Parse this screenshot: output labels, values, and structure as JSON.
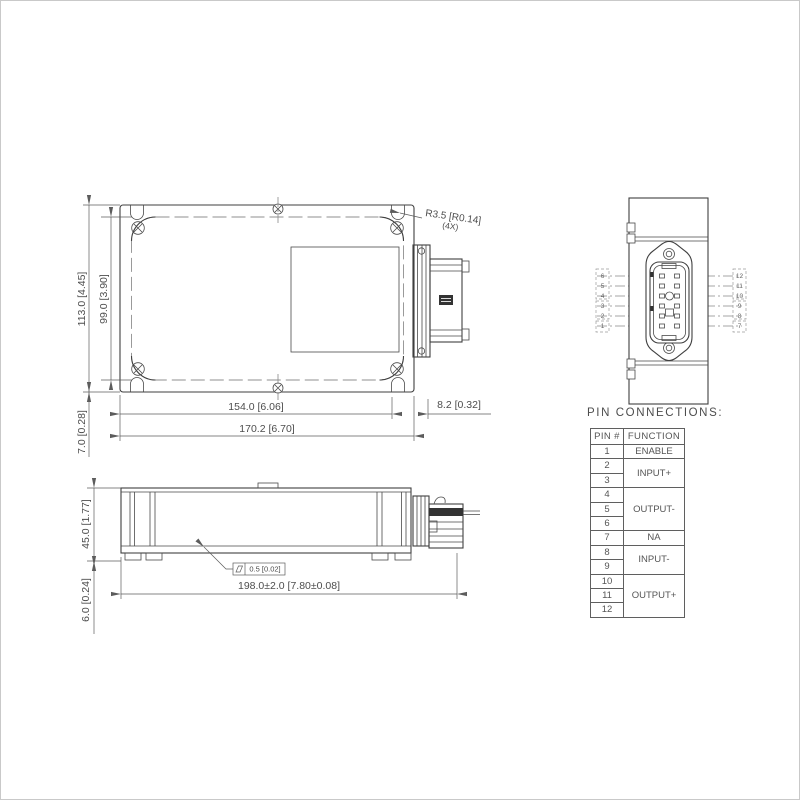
{
  "drawing": {
    "top_view": {
      "dim_height_outer": "113.0 [4.45]",
      "dim_height_inner": "99.0 [3.90]",
      "dim_edge_offset": "7.0 [0.28]",
      "dim_width_inner": "154.0 [6.06]",
      "dim_width_outer": "170.2 [6.70]",
      "dim_connector": "8.2 [0.32]",
      "radius_callout": "R3.5 [R0.14]",
      "radius_qty": "(4X)"
    },
    "side_view": {
      "dim_height": "45.0 [1.77]",
      "dim_base": "6.0 [0.24]",
      "dim_length": "198.0±2.0 [7.80±0.08]",
      "flatness_value": "0.5 [0.02]"
    },
    "end_view": {
      "left_pins": [
        "6",
        "5",
        "4",
        "3",
        "2",
        "1"
      ],
      "right_pins": [
        "12",
        "11",
        "10",
        "9",
        "8",
        "7"
      ]
    }
  },
  "pin_table": {
    "title": "PIN CONNECTIONS:",
    "col_pin": "PIN #",
    "col_function": "FUNCTION",
    "groups": [
      {
        "pins": [
          "1"
        ],
        "function": "ENABLE"
      },
      {
        "pins": [
          "2",
          "3"
        ],
        "function": "INPUT+"
      },
      {
        "pins": [
          "4",
          "5",
          "6"
        ],
        "function": "OUTPUT-"
      },
      {
        "pins": [
          "7"
        ],
        "function": "NA"
      },
      {
        "pins": [
          "8",
          "9"
        ],
        "function": "INPUT-"
      },
      {
        "pins": [
          "10",
          "11",
          "12"
        ],
        "function": "OUTPUT+"
      }
    ]
  }
}
